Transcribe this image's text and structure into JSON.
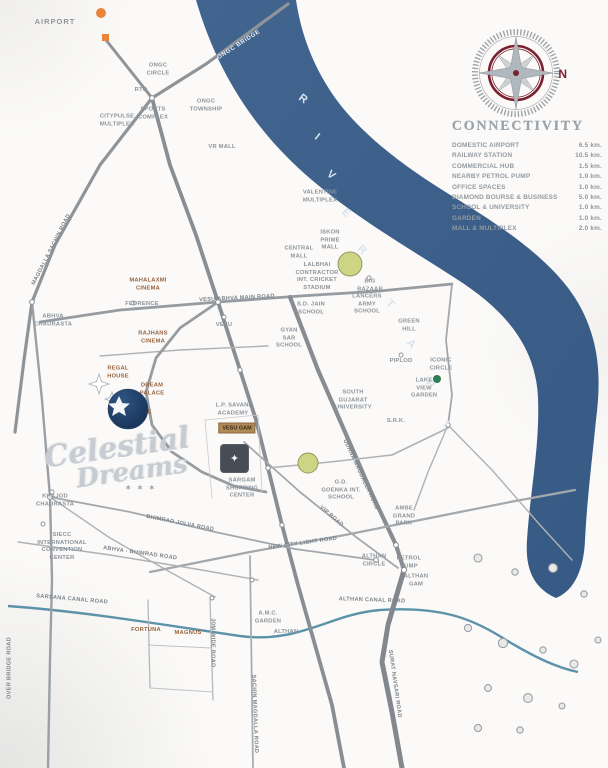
{
  "colors": {
    "river": "#3e6190",
    "canal": "#5d93a8",
    "compass_red": "#7a2230",
    "brown_label": "#96643f",
    "orange": "#e8853a",
    "green_area": "#cdd584",
    "site": "#474c55"
  },
  "compass": {
    "north": "N"
  },
  "connectivity": {
    "title": "CONNECTIVITY",
    "rows": [
      {
        "label": "DOMESTIC AIRPORT",
        "value": "6.5 km."
      },
      {
        "label": "RAILWAY STATION",
        "value": "10.5 km."
      },
      {
        "label": "COMMERCIAL HUB",
        "value": "1.5 km."
      },
      {
        "label": "NEARBY PETROL PUMP",
        "value": "1.0 km."
      },
      {
        "label": "OFFICE SPACES",
        "value": "1.0 km."
      },
      {
        "label": "DIAMOND BOURSE & BUSINESS",
        "value": "5.0 km."
      },
      {
        "label": "SCHOOL & UNIVERSITY",
        "value": "1.0 km."
      },
      {
        "label": "GARDEN",
        "value": "1.0 km."
      },
      {
        "label": "MALL & MULTIPLEX",
        "value": "2.0 km."
      }
    ]
  },
  "river": {
    "name": "RIVER TAPI",
    "letters": [
      "R",
      "I",
      "V",
      "E",
      "R",
      "T",
      "A",
      "P",
      "I"
    ],
    "bridge": "ONGC BRIDGE"
  },
  "logo": {
    "line1": "Celestial",
    "line2": "Dreams",
    "stars": "✶ ✶ ✶"
  },
  "site": {
    "box_label": "VESU GAM",
    "marker_glyph": "✦"
  },
  "labels": [
    {
      "text": "AIRPORT"
    },
    {
      "text": "ONGC CIRCLE"
    },
    {
      "text": "RTO"
    },
    {
      "text": "SPORTS COMPLEX"
    },
    {
      "text": "CITYPULSE MULTIPLEX"
    },
    {
      "text": "ONGC TOWNSHIP"
    },
    {
      "text": "VR MALL"
    },
    {
      "text": "VALENTINE MULTIPLEX"
    },
    {
      "text": "ISKON PRIME MALL"
    },
    {
      "text": "CENTRAL MALL"
    },
    {
      "text": "LALBHAI CONTRACTOR INT. CRICKET STADIUM"
    },
    {
      "text": "BIG BAZAAR"
    },
    {
      "text": "LANCERS ARMY SCHOOL"
    },
    {
      "text": "S.D. JAIN SCHOOL"
    },
    {
      "text": "GYAN SAR SCHOOL"
    },
    {
      "text": "GREEN HILL"
    },
    {
      "text": "PIPLOD"
    },
    {
      "text": "ICONIC CIRCLE"
    },
    {
      "text": "LAKE VIEW GARDEN"
    },
    {
      "text": "VESU"
    },
    {
      "text": "MAHALAXMI CINEMA"
    },
    {
      "text": "FLORENCE"
    },
    {
      "text": "RAJHANS CINEMA"
    },
    {
      "text": "REGAL HOUSE"
    },
    {
      "text": "DREAM PALACE"
    },
    {
      "text": "ROYAL HERITAGE"
    },
    {
      "text": "L.P. SAVANI ACADEMY"
    },
    {
      "text": "SARGAM SHOPPING CENTER"
    },
    {
      "text": "SOUTH GUJARAT UNIVERSITY"
    },
    {
      "text": "S.R.K."
    },
    {
      "text": "G.D. GOENKA INT. SCHOOL"
    },
    {
      "text": "AMBE GRAND PARK"
    },
    {
      "text": "KHAJOD CHAURASTA"
    },
    {
      "text": "SIECC INTERNATIONAL CONVENTION CENTER"
    },
    {
      "text": "ABHVA CHAURASTA"
    },
    {
      "text": "A.M.C. GARDEN"
    },
    {
      "text": "ALTHAN"
    },
    {
      "text": "FORTUNA"
    },
    {
      "text": "MAGNUS"
    },
    {
      "text": "ALTHAN CIRCLE"
    },
    {
      "text": "PETROL PUMP"
    },
    {
      "text": "ALTHAN GAM"
    }
  ],
  "road_labels": [
    {
      "text": "MAGDALLA SACHIN ROAD"
    },
    {
      "text": "VESU ABHVA MAIN ROAD"
    },
    {
      "text": "UDHNA MAGDALLA ROAD"
    },
    {
      "text": "VIP ROAD"
    },
    {
      "text": "NEW CITY LIGHT ROAD"
    },
    {
      "text": "BHIMRAD JOLVA ROAD"
    },
    {
      "text": "ABHVA - BHIMRAD ROAD"
    },
    {
      "text": "ALTHAN CANAL ROAD"
    },
    {
      "text": "SARSANA CANAL ROAD"
    },
    {
      "text": "30M WIDE ROAD"
    },
    {
      "text": "SACHIN MAGDALLA ROAD"
    },
    {
      "text": "SURAT NAVSARI ROAD"
    },
    {
      "text": "OVER BRIDGE ROAD"
    }
  ]
}
